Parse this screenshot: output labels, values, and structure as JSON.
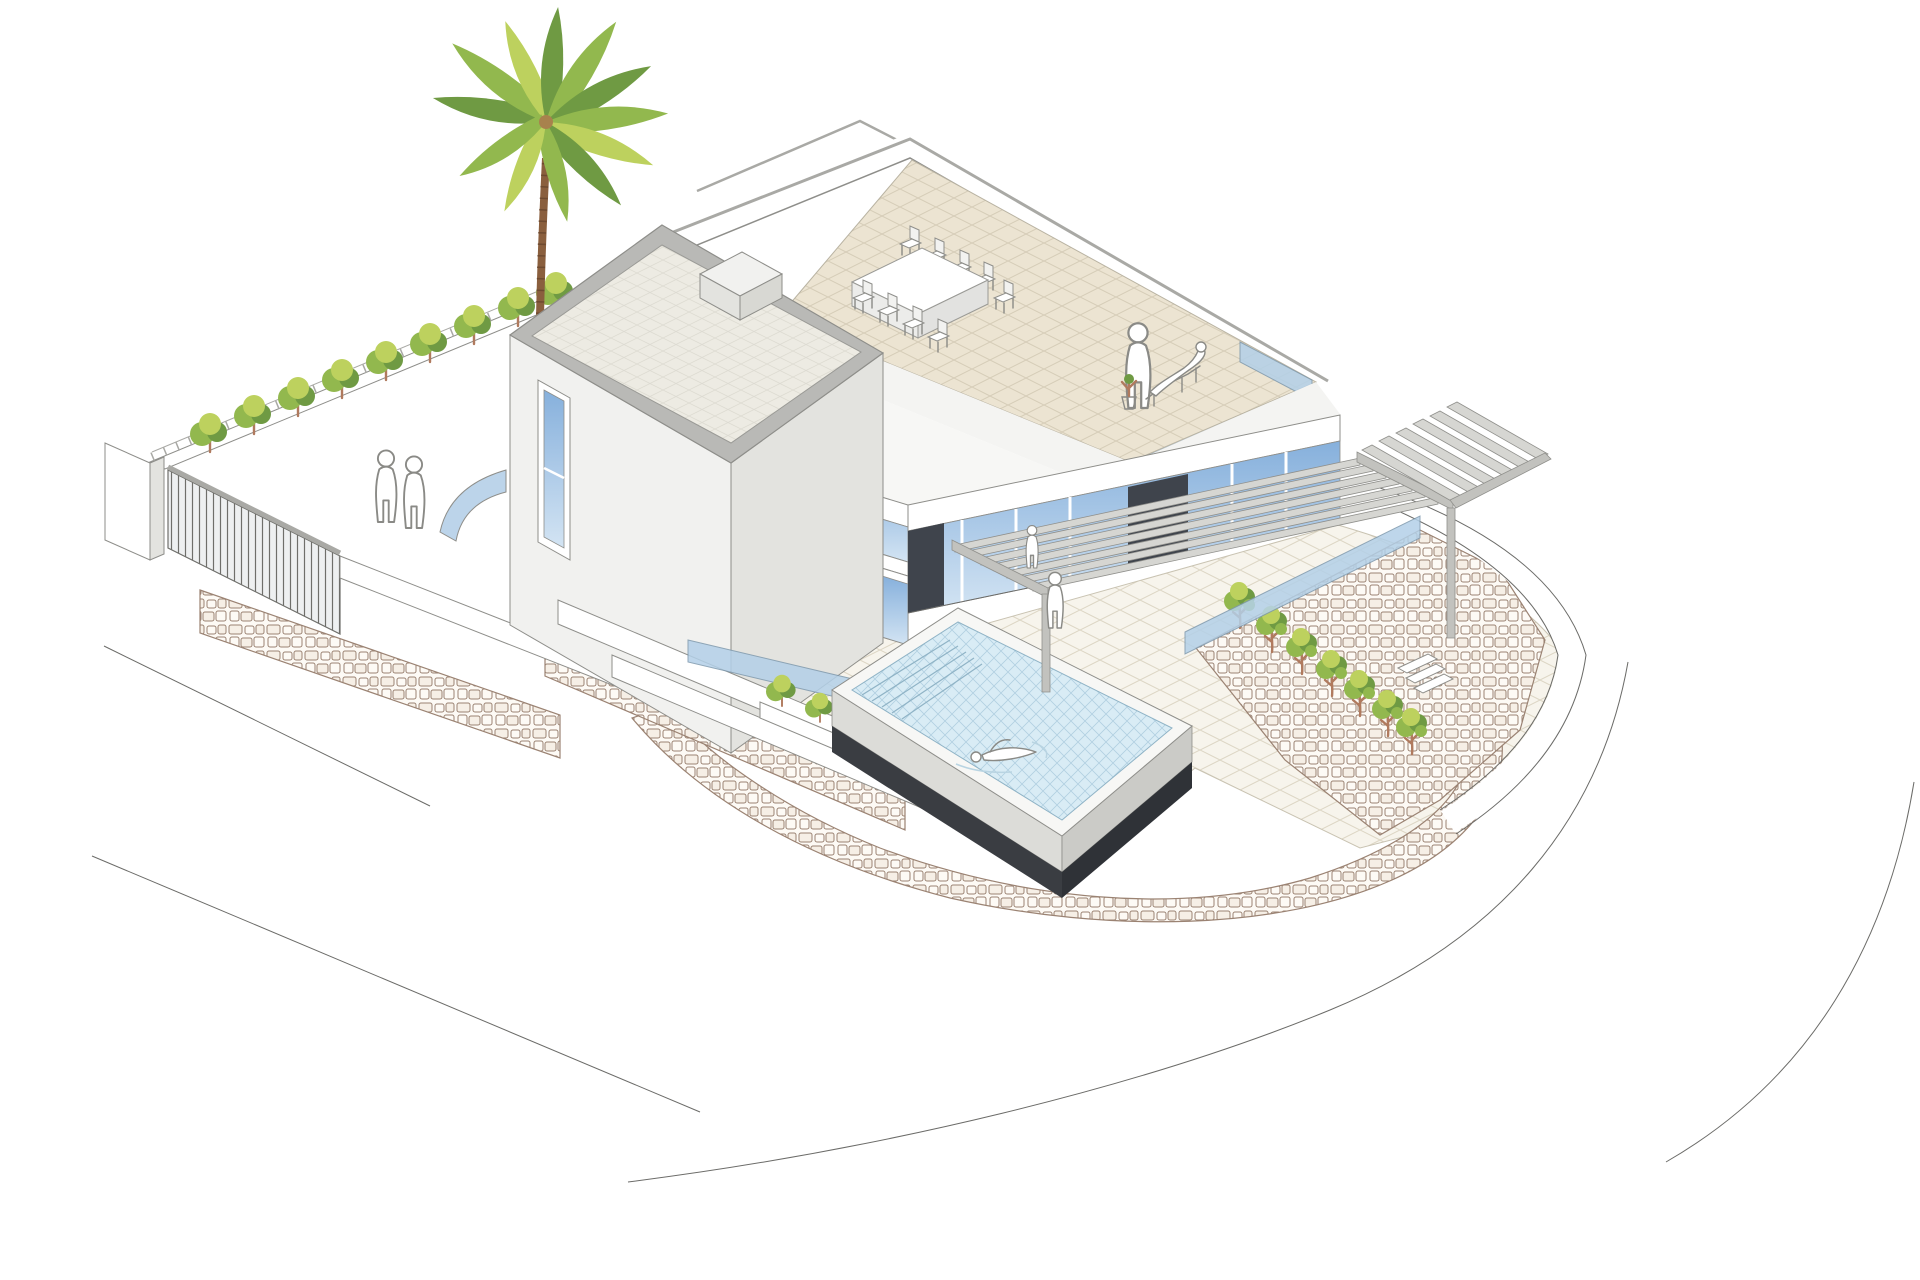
{
  "illustration": {
    "type": "axonometric-architectural-rendering",
    "subject": "Modern two-storey villa with roof terrace, pergola and raised infinity pool",
    "style": "line drawing with flat pastel fills on white background",
    "projection": "isometric"
  },
  "scene": {
    "building": {
      "tower": "two-storey cube with flat parapet roof and narrow vertical window slit",
      "main_wing": "single-storey glazed wing with roof terrace",
      "roof_terrace": "beige tiled deck with dining table, eight chairs, standing figure, lounge figure and potted plant",
      "pergola": "grey slatted canopy on two slender posts wrapping the south-east corner",
      "facade": "floor-to-ceiling blue glazing with dark panels and louvered screen",
      "chimney": "small rooftop box"
    },
    "landscape": {
      "pool": "raised square infinity pool with steps, light blue hatched water and charcoal base",
      "swimmer": "single swimmer figure in pool",
      "patio": "cream diagonal-tiled deck around pool",
      "garden_left": "walled garden with row of nine shrubs, slatted gate and two standing figures",
      "garden_right": "curved terraced bank with row of seven small trees and steps",
      "palm_tree": "tall palm at rear left",
      "stone_walls": "curved cobble-textured retaining walls",
      "roads": "thin curved road outlines at bottom"
    },
    "people_count": 6,
    "terrace_chairs_count": 9,
    "garden_shrubs_count": 9,
    "right_trees_count": 7
  },
  "colors": {
    "line": "#6b6b68",
    "edge": "#8e8e8a",
    "cap": "#a9a9a5",
    "figure": "#8a8a86",
    "wall": "#f1f1ef",
    "wallMid": "#e3e3df",
    "wallShade": "#d8d8d3",
    "roofTile": "#edebe3",
    "roofTileLine": "#dddbd2",
    "terrace": "#ece4d2",
    "terraceLine": "#d6cdb8",
    "patio": "#f7f4ec",
    "patioLine": "#ddd6c4",
    "glassTop": "#86b0dc",
    "glassBottom": "#d3e4f3",
    "balustrade": "#b3d0e8",
    "baluEdge": "#7d98ad",
    "darkPanel": "#3f444c",
    "louver": "#b4bac0",
    "slat": "#d6d6d2",
    "slatSide": "#9e9e9a",
    "slatEdge": "#90908c",
    "beam": "#c2c2be",
    "water": "#d9ecf5",
    "waterLine": "#a6c8db",
    "coping": "#f7f7f5",
    "poolWall": "#dcdcd8",
    "poolWall2": "#cbcbc7",
    "poolBase": "#3a3d42",
    "poolBase2": "#2f3237",
    "stoneLine": "#9b8373",
    "stoneBg": "#fdfaf5",
    "stoneCell": "#f6efe6",
    "leafDark": "#6f9a43",
    "leafMid": "#92b84e",
    "leafLight": "#bdd15e",
    "trunk": "#8a5f3e",
    "trunkRing": "#6e4a30",
    "stem": "#b07a5e"
  }
}
